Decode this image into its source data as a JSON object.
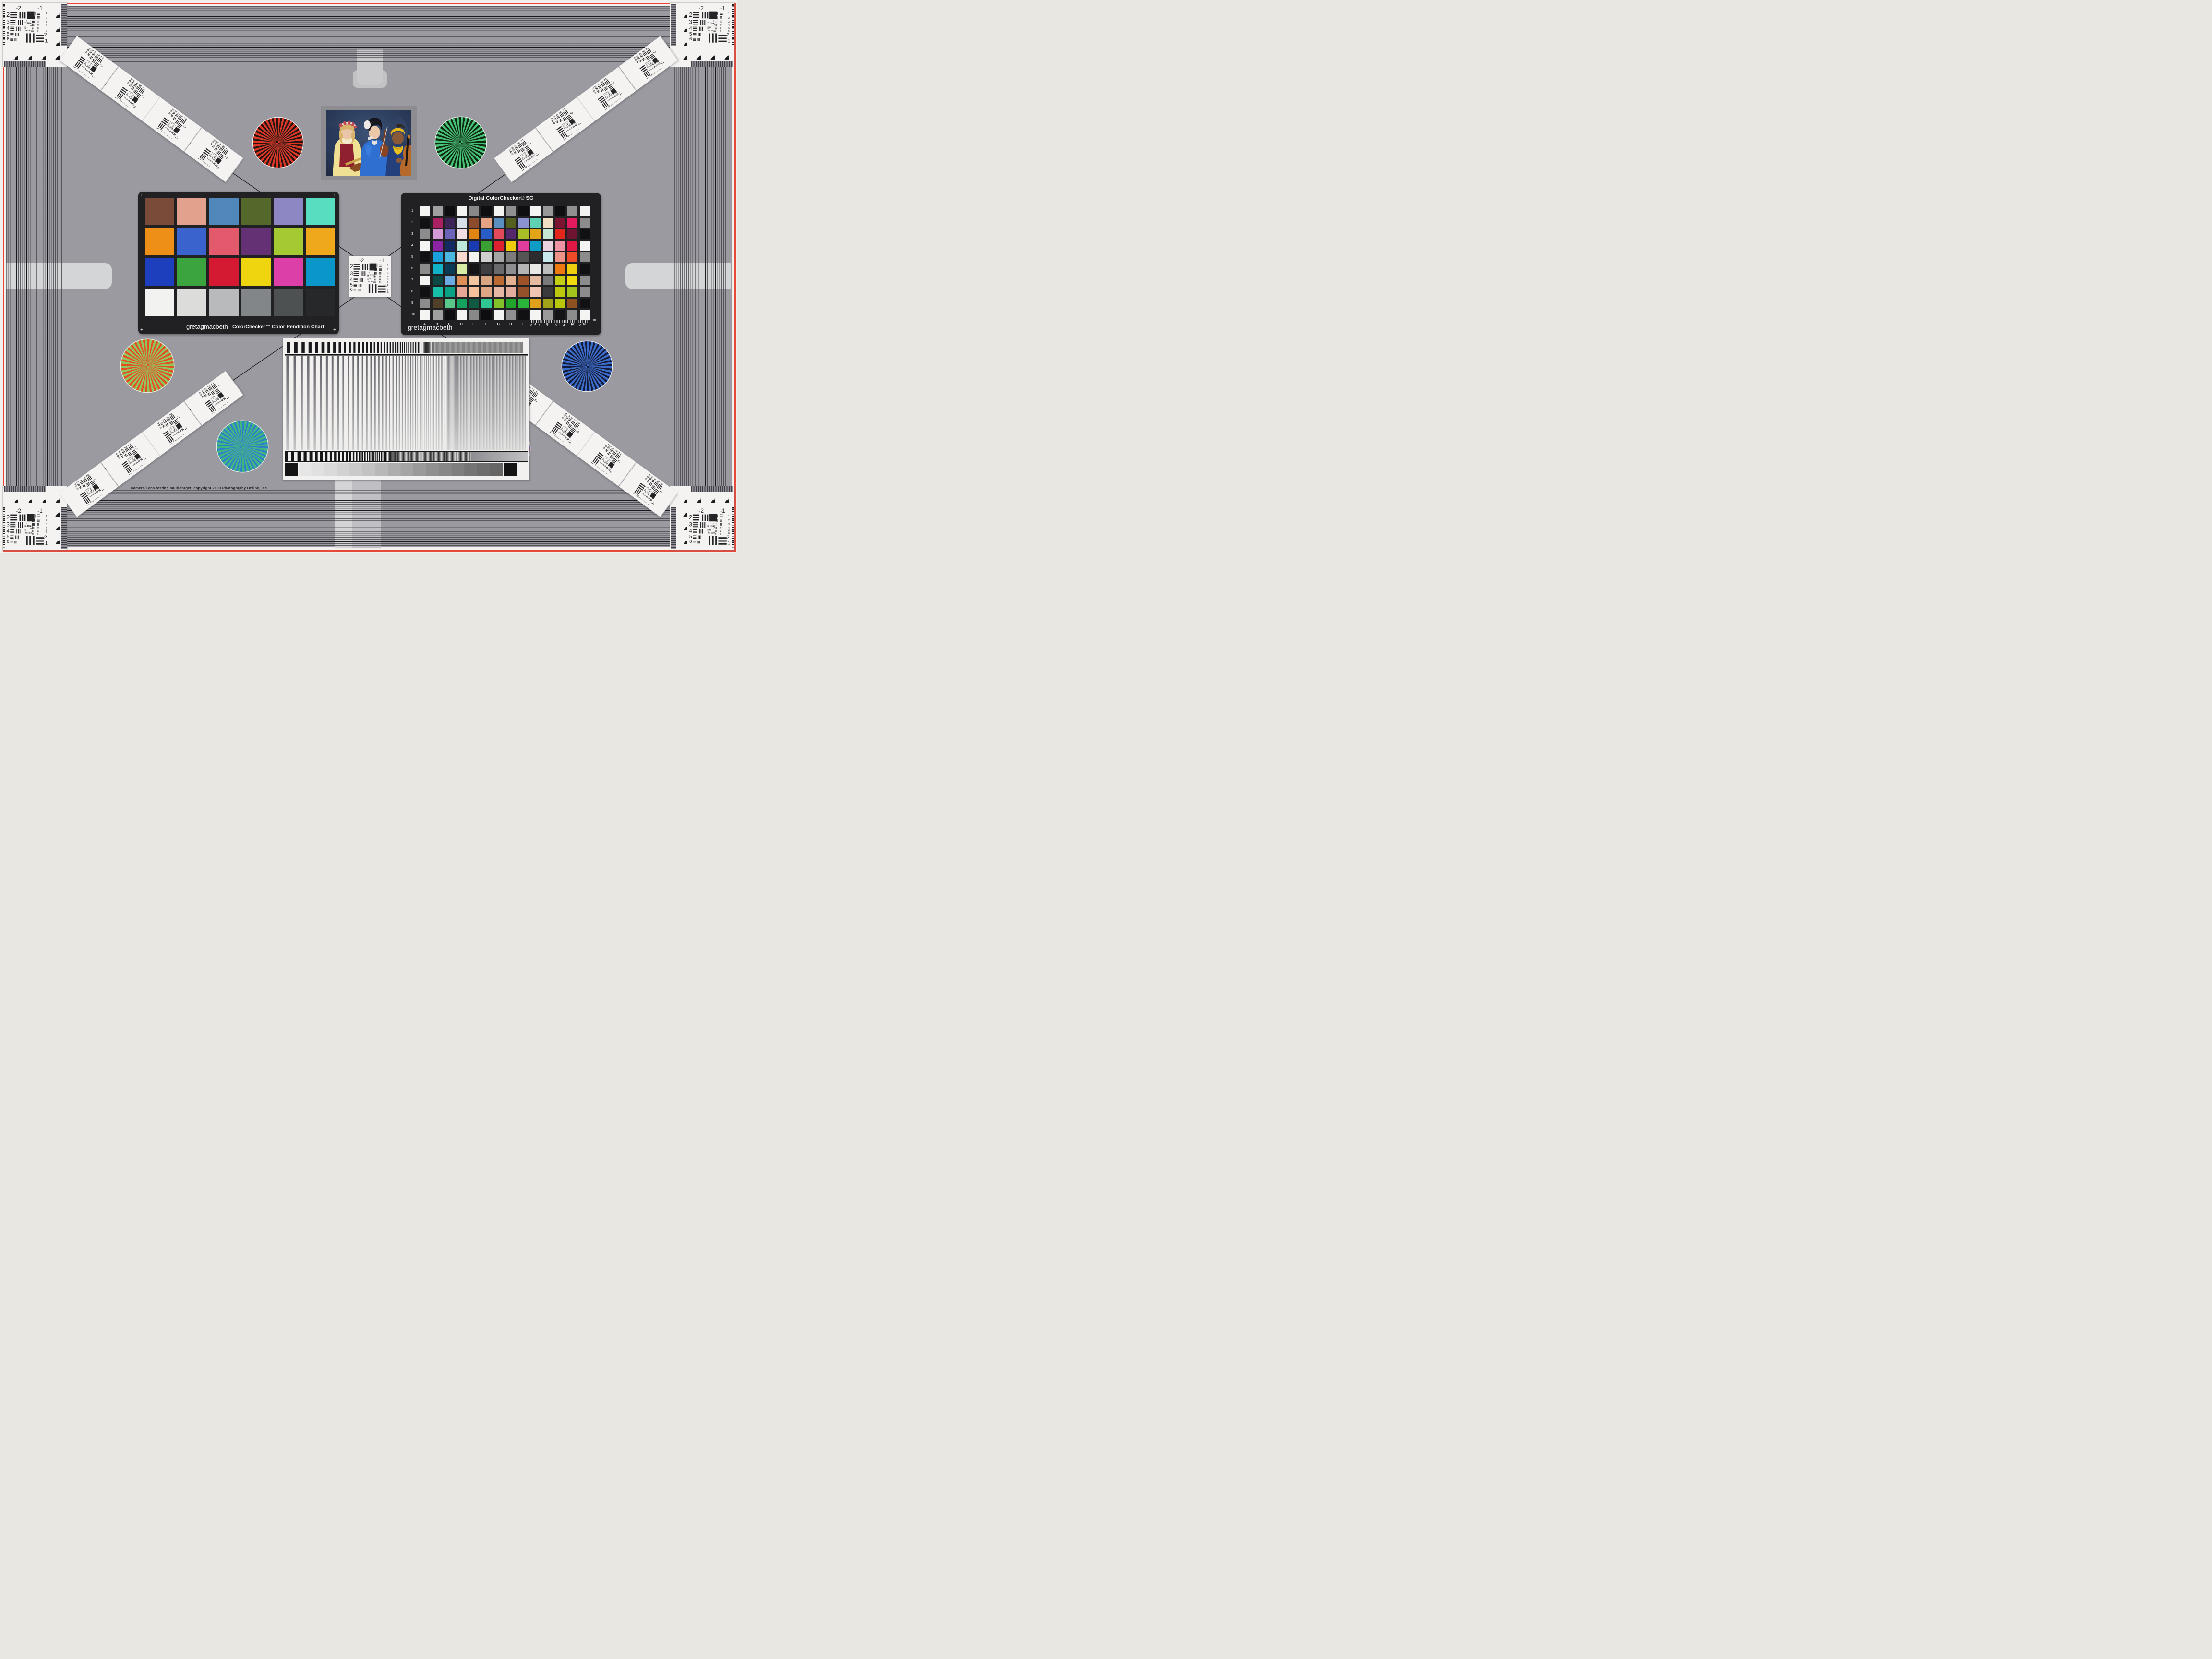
{
  "copyright_line": "Camera/Lens testing multi-target, copyright 2009 Photography Online, Inc.",
  "palette": {
    "field": "#9a9aa0",
    "red_border": "#e84838",
    "card_white": "#f4f3f1",
    "chart_black": "#212123",
    "line_dark": "#1c1c20"
  },
  "usaf": {
    "top_left_label": "-2",
    "top_right_label": "-1",
    "left_row_labels": [
      "2",
      "3",
      "4",
      "5",
      "6"
    ],
    "right_row_labels": [
      "1",
      "2",
      "3",
      "4",
      "5",
      "6"
    ],
    "bottom_right_labels": [
      "-2",
      "1"
    ],
    "inner_labels": [
      "0",
      "1"
    ]
  },
  "colorchecker": {
    "brand": "gretagmacbeth",
    "name": "ColorChecker™ Color Rendition Chart",
    "corner_mark": "+",
    "patches": [
      "#7a4b38",
      "#e2a18c",
      "#5088bc",
      "#55682c",
      "#8d87c4",
      "#59ddc1",
      "#ee8f17",
      "#3a63ce",
      "#e25a6c",
      "#643175",
      "#a4c932",
      "#efa81c",
      "#1d3fbd",
      "#3ba43f",
      "#d41a32",
      "#efd410",
      "#dd3fa8",
      "#0b96ca",
      "#f2f2f0",
      "#dcdcda",
      "#b8babb",
      "#828688",
      "#4e5152",
      "#272829"
    ]
  },
  "sg": {
    "title": "Digital ColorChecker® SG",
    "brand": "gretagmacbeth",
    "columns": [
      "A",
      "B",
      "C",
      "D",
      "E",
      "F",
      "G",
      "H",
      "I",
      "J",
      "K",
      "L",
      "M",
      "N"
    ],
    "rows": [
      "1",
      "2",
      "3",
      "4",
      "5",
      "6",
      "7",
      "8",
      "9",
      "10"
    ],
    "ruler": {
      "labels": [
        "0",
        "1",
        "2",
        "3",
        "4",
        "5",
        "6"
      ],
      "unit": "mm"
    },
    "patches": [
      [
        "#f4f4f2",
        "#a0a0a0",
        "#0e0e10",
        "#f4f4f2",
        "#888888",
        "#0e0e10",
        "#f4f4f2",
        "#909090",
        "#0e0e10",
        "#f4f4f2",
        "#989898",
        "#0e0e10",
        "#909090",
        "#f4f4f2"
      ],
      [
        "#111113",
        "#ab1f63",
        "#3c2458",
        "#d7e0e8",
        "#8c4b2d",
        "#e5a285",
        "#5a8fc0",
        "#53601f",
        "#8b93d1",
        "#5ed1b4",
        "#f2dec2",
        "#7c1330",
        "#e31a5e",
        "#8c8c8c"
      ],
      [
        "#8c8c8c",
        "#d59ad6",
        "#6a63b8",
        "#f1dde4",
        "#e08414",
        "#2a5cc8",
        "#e2495a",
        "#55286e",
        "#a7bc25",
        "#e3a518",
        "#c5e8d4",
        "#e5261c",
        "#6e1430",
        "#111113"
      ],
      [
        "#f4f4f2",
        "#8b24a2",
        "#142a62",
        "#bfe8dc",
        "#1a3bb0",
        "#3aa033",
        "#de2130",
        "#eecb0b",
        "#e23c9e",
        "#0f9cc6",
        "#ead2e0",
        "#ef93a4",
        "#e21844",
        "#f4f4f2"
      ],
      [
        "#111113",
        "#1aa0dc",
        "#4bb6e0",
        "#f6d9cf",
        "#f2f2f0",
        "#cfcfcf",
        "#a5a5a5",
        "#7c7c7c",
        "#555555",
        "#2c2c2e",
        "#c6e8ee",
        "#ef9288",
        "#ee4b28",
        "#8c8c8c"
      ],
      [
        "#8c8c8c",
        "#12b3c6",
        "#0b3a57",
        "#d8eca6",
        "#141416",
        "#3f3f41",
        "#6a6a6c",
        "#8f8f91",
        "#b5b5b5",
        "#e8e8e6",
        "#bdbdbd",
        "#ef7911",
        "#eecf10",
        "#111113"
      ],
      [
        "#f4f4f2",
        "#0c4844",
        "#6cabe2",
        "#dd8f57",
        "#f3c5a0",
        "#d8a482",
        "#bb6a33",
        "#e5b291",
        "#9e5428",
        "#e6baa0",
        "#7a7a7a",
        "#c4cf14",
        "#f0d90c",
        "#8c8c8c"
      ],
      [
        "#111113",
        "#16bfa6",
        "#0ba184",
        "#e8a795",
        "#f7c29b",
        "#dfa686",
        "#e7b7a6",
        "#e3ac9c",
        "#94512a",
        "#f0c4b2",
        "#3a3a3c",
        "#bcc70e",
        "#a3c21c",
        "#8c8c8c"
      ],
      [
        "#8c8c8c",
        "#4f4027",
        "#5bc88b",
        "#15a25f",
        "#0f5a40",
        "#2fc892",
        "#83c32a",
        "#22a32b",
        "#2bb53a",
        "#dfa11c",
        "#a3a31a",
        "#b8c70a",
        "#8e5221",
        "#111113"
      ],
      [
        "#f4f4f2",
        "#a0a0a0",
        "#0e0e10",
        "#f4f4f2",
        "#888888",
        "#0e0e10",
        "#f4f4f2",
        "#909090",
        "#111113",
        "#f4f4f2",
        "#9a9a9a",
        "#141416",
        "#8c8c8c",
        "#f4f4f2"
      ]
    ]
  },
  "stars": [
    {
      "name": "red-siemens-star",
      "colors": [
        "#e03524",
        "#2a120e"
      ]
    },
    {
      "name": "green-siemens-star",
      "colors": [
        "#44c474",
        "#0c2a12"
      ]
    },
    {
      "name": "orange-green-siemens-star",
      "colors": [
        "#e05020",
        "#8cc860"
      ]
    },
    {
      "name": "blue-siemens-star",
      "colors": [
        "#3a6cd0",
        "#111c3a"
      ]
    },
    {
      "name": "blue-green-siemens-star",
      "colors": [
        "#2f7fc8",
        "#3cb878"
      ]
    },
    {
      "name": "red-blue-siemens-star",
      "colors": [
        "#d62f4a",
        "#4753c2"
      ]
    }
  ],
  "grayscale_steps": [
    "#e6e6e6",
    "#e0e0e0",
    "#dadada",
    "#d2d2d2",
    "#cacaca",
    "#c2c2c2",
    "#b8b8b8",
    "#aeaeae",
    "#a4a4a4",
    "#9a9a9a",
    "#909090",
    "#878787",
    "#7e7e7e",
    "#757575",
    "#6d6d6d",
    "#666666"
  ]
}
